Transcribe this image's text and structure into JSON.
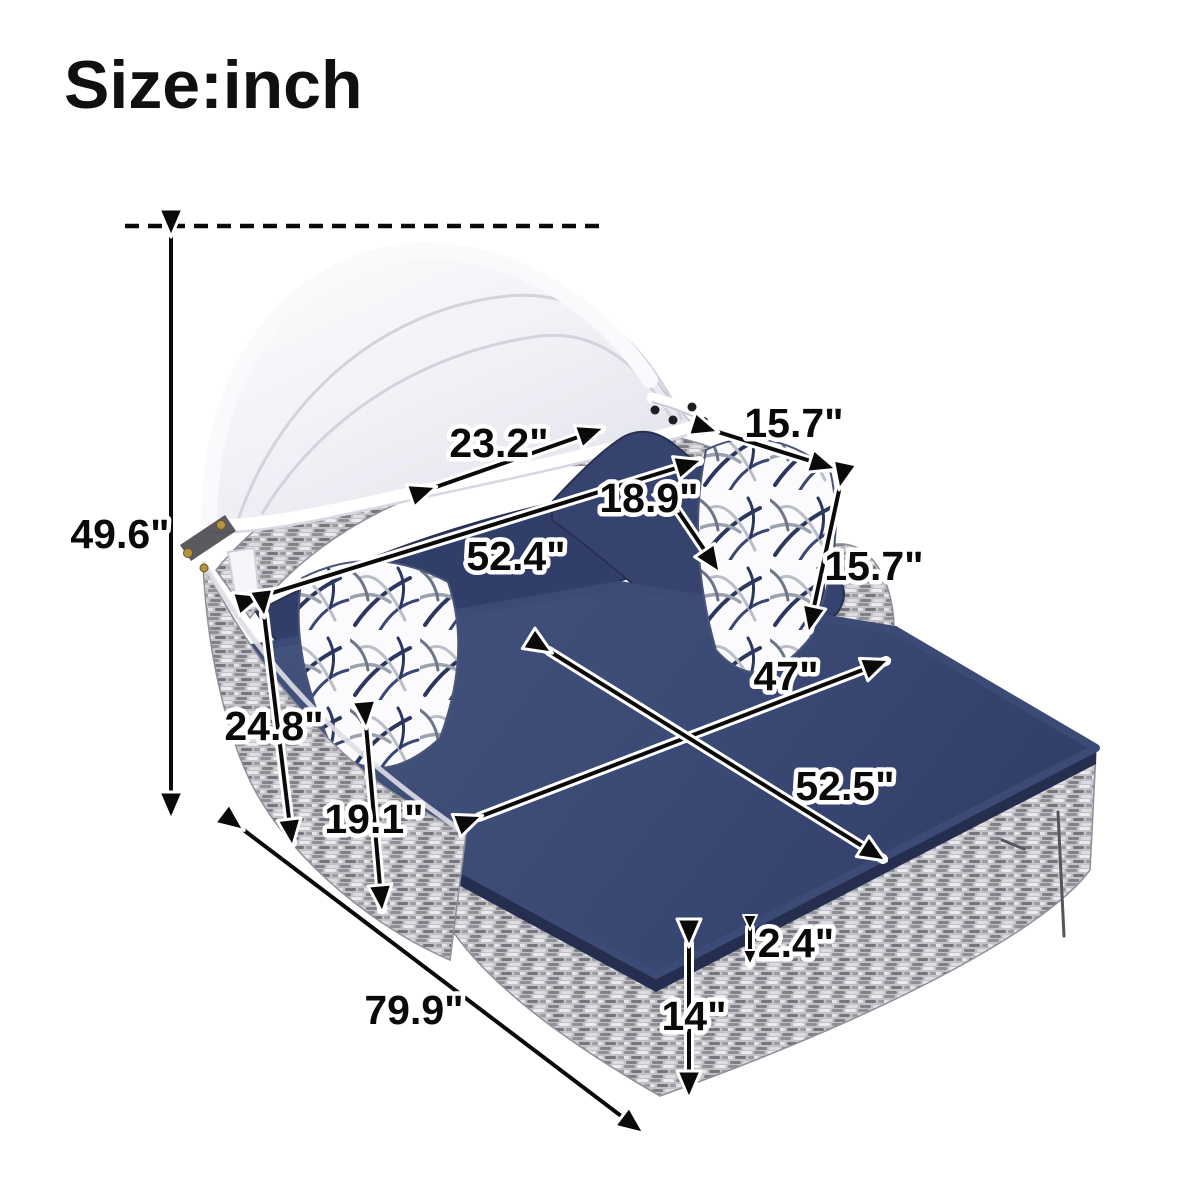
{
  "title": "Size:inch",
  "dimensions": {
    "overall_height": "49.6\"",
    "canopy_back_width": "23.2\"",
    "pillow_top_width": "15.7\"",
    "pillow_diagonal": "18.9\"",
    "backrest_length": "52.4\"",
    "pillow_side_height": "15.7\"",
    "seat_width": "47\"",
    "seat_length": "52.5\"",
    "arm_height": "24.8\"",
    "side_panel_height": "19.1\"",
    "cushion_thickness": "2.4\"",
    "base_height": "14\"",
    "overall_length": "79.9\""
  },
  "colors": {
    "cushion_navy": "#3c4a76",
    "cushion_navy_dark": "#27304f",
    "cushion_side_navy": "#262e50",
    "wicker_gray": "#c1c1c6",
    "canopy_white": "#f5f5f9",
    "annotation_black": "#0a0a0a",
    "halo_white": "#ffffff",
    "hinge_gold": "#b5923f"
  }
}
